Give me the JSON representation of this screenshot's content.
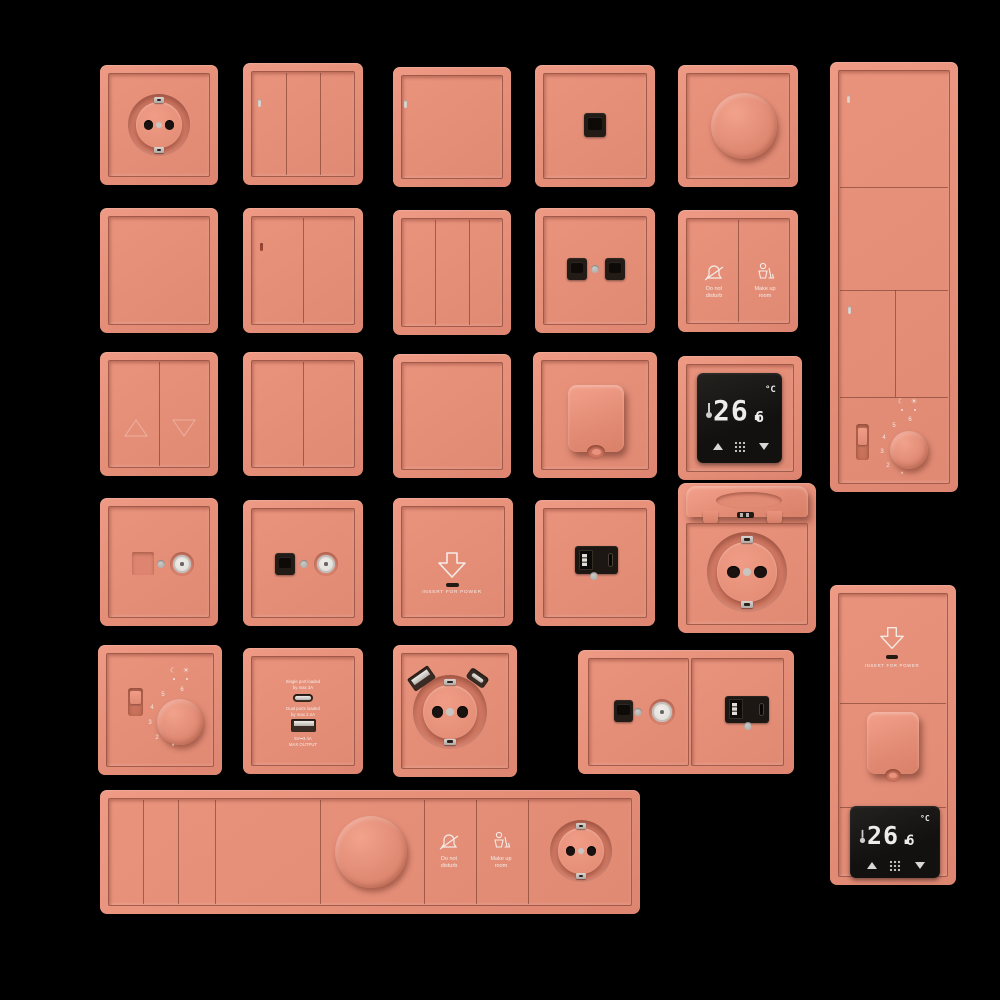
{
  "background": "#000000",
  "colors": {
    "plate_salmon": "#E8917B",
    "plate_shadowline": "#60281C",
    "insert_black": "#1C1713",
    "display_black": "#161412",
    "display_digits": "#ECECEA",
    "label_white": "#F5ECE7",
    "led_lit": "#DDD6D0",
    "led_unlit": "#9C4634",
    "metal_gray": "#C9C5C1"
  },
  "icons": {
    "moon": "☾",
    "sun": "☀"
  },
  "labels": {
    "dnd1": "Do not",
    "dnd2": "disturb",
    "mur1": "Make up",
    "mur2": "room",
    "insert": "INSERT FOR POWER",
    "temp_main": "26.",
    "temp_dec": "6",
    "temp_unit": "°C",
    "dial": [
      "6",
      "5",
      "4",
      "3",
      "2",
      "*"
    ],
    "usb_c_note1": "Single port loaded",
    "usb_c_note2": "by max 3A",
    "usb_a_note1": "Dual ports loaded",
    "usb_a_note2": "by max 2.4A",
    "usb_rating1": "5V⎓3.4A",
    "usb_rating2": "MAX OUTPUT"
  },
  "panels": [
    "schuko-socket",
    "switch-3-gang-led",
    "switch-1-gang-led",
    "data-outlet-single",
    "rotary-dimmer",
    "vertical-multiframe-switches-thermostat",
    "switch-1-gang-plain",
    "switch-2-gang-led",
    "switch-3-gang-plain",
    "data-outlet-double",
    "hotel-service-switch",
    "blind-switch",
    "switch-2-gang-plain",
    "switch-1-gang-plain-2",
    "covered-socket-closed",
    "smart-thermostat-display",
    "tv-socket",
    "data-tv-socket",
    "keycard-power-holder",
    "usb-a-c-charger",
    "covered-socket-open",
    "rotary-thermostat",
    "usb-charger-labeled",
    "schuko-usb-socket",
    "data-tv-usb-combo",
    "vertical-multiframe-keycard-socket-thermostat",
    "horizontal-multiframe-switches-dimmer-service-socket"
  ]
}
